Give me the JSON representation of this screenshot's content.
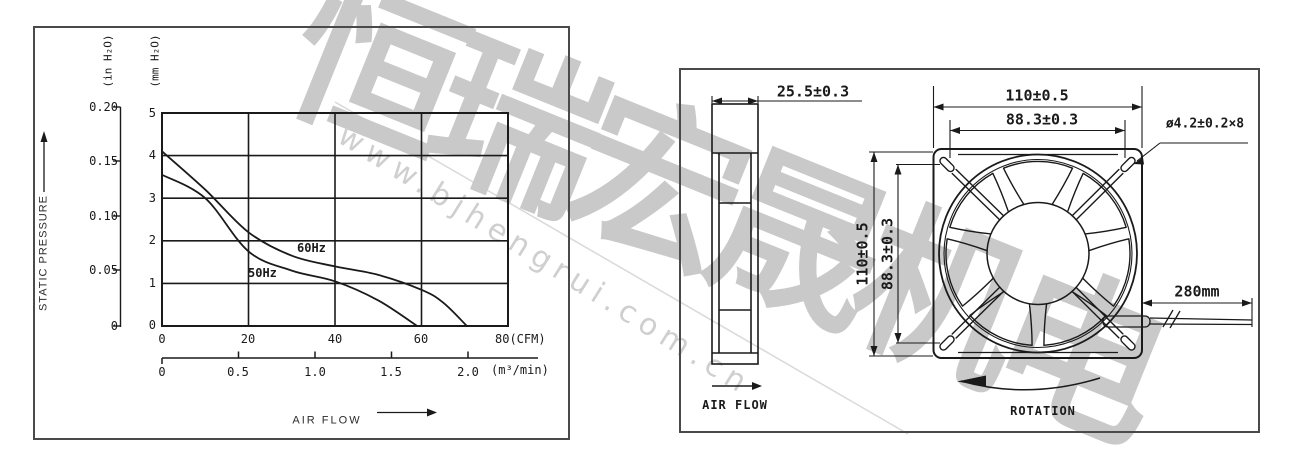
{
  "watermark": {
    "company": "恒瑞宏晟机电",
    "url": "www.bjhengrui.com.cn"
  },
  "performance_chart": {
    "pressure_axis": {
      "title": "STATIC PRESSURE",
      "unit_in": "(in H₂O)",
      "unit_mm": "(mm H₂O)",
      "in_ticks": [
        "0.20",
        "0.15",
        "0.10",
        "0.05",
        "0"
      ],
      "mm_ticks": [
        "5",
        "4",
        "3",
        "2",
        "1",
        "0"
      ]
    },
    "flow_axis": {
      "title": "AIR FLOW",
      "cfm_ticks": [
        "0",
        "20",
        "40",
        "60"
      ],
      "cfm_last": "80(CFM)",
      "m3_ticks": [
        "0",
        "0.5",
        "1.0",
        "1.5",
        "2.0"
      ],
      "m3_unit": "(m³/min)"
    },
    "curve_labels": {
      "hz60": "60Hz",
      "hz50": "50Hz"
    }
  },
  "chart_data": {
    "type": "line",
    "title": "Static pressure vs air flow characteristic",
    "xlabel": "AIR FLOW",
    "ylabel": "STATIC PRESSURE",
    "x_units": [
      "CFM",
      "m³/min"
    ],
    "y_units": [
      "in H₂O",
      "mm H₂O"
    ],
    "xlim_cfm": [
      0,
      80
    ],
    "ylim_mm": [
      0,
      5
    ],
    "x_ticks_cfm": [
      0,
      20,
      40,
      60,
      80
    ],
    "x_ticks_m3min": [
      0,
      0.5,
      1.0,
      1.5,
      2.0
    ],
    "y_ticks_mm": [
      0,
      1,
      2,
      3,
      4,
      5
    ],
    "y_ticks_in": [
      0,
      0.05,
      0.1,
      0.15,
      0.2
    ],
    "grid": true,
    "legend_position": "labels on curves",
    "series": [
      {
        "name": "60Hz",
        "points_cfm_mm": [
          [
            0,
            4.1
          ],
          [
            10,
            3.2
          ],
          [
            20,
            2.2
          ],
          [
            30,
            1.65
          ],
          [
            40,
            1.4
          ],
          [
            50,
            1.2
          ],
          [
            60,
            0.85
          ],
          [
            65,
            0.55
          ],
          [
            70.5,
            0
          ]
        ]
      },
      {
        "name": "50Hz",
        "points_cfm_mm": [
          [
            0,
            3.55
          ],
          [
            10,
            3.0
          ],
          [
            20,
            1.75
          ],
          [
            30,
            1.3
          ],
          [
            40,
            1.05
          ],
          [
            50,
            0.6
          ],
          [
            59,
            0
          ]
        ]
      }
    ]
  },
  "dimension_drawing": {
    "side_view": {
      "depth_dim": "25.5±0.3",
      "air_flow_label": "AIR FLOW"
    },
    "front_view": {
      "width_dim": "110±0.5",
      "hole_pitch_h_dim": "88.3±0.3",
      "height_dim": "110±0.5",
      "hole_pitch_v_dim": "88.3±0.3",
      "hole_callout": "ø4.2±0.2×8",
      "lead_wire_dim": "280mm",
      "rotation_label": "ROTATION"
    }
  }
}
